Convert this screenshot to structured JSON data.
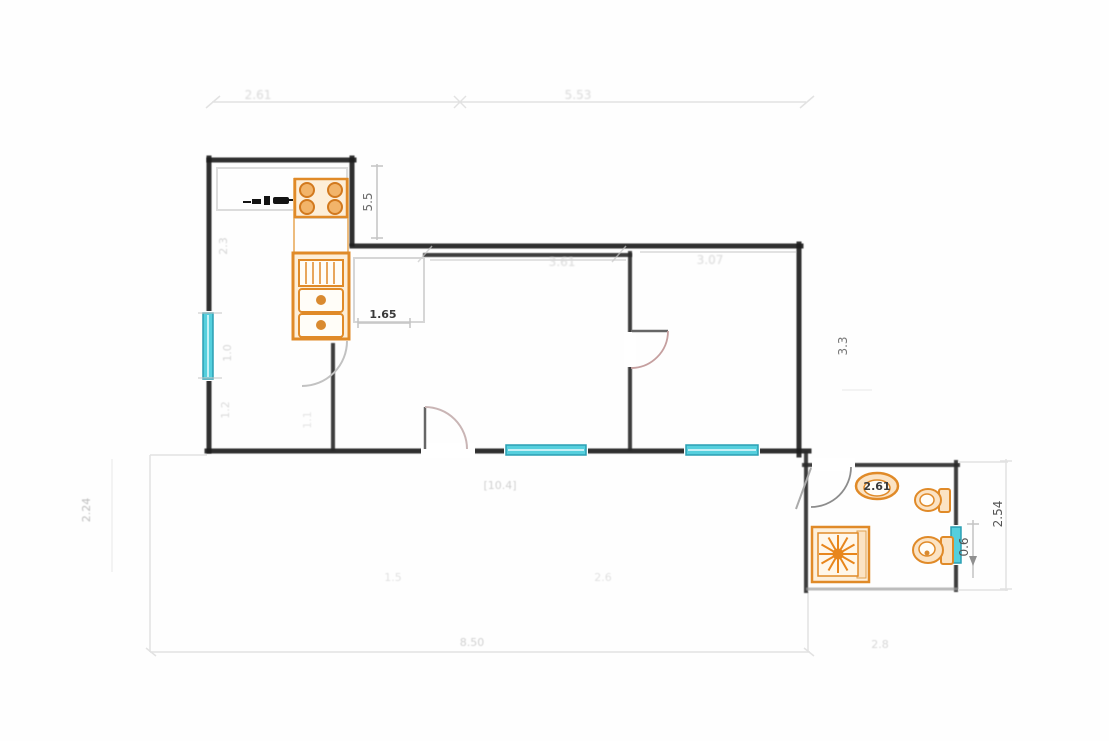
{
  "meta": {
    "drawing_type": "apartment floor plan scan",
    "rooms": [
      "kitchen",
      "hall",
      "living-room",
      "bedroom",
      "bathroom",
      "terrace"
    ],
    "fixtures": [
      "stove",
      "kitchen-sink",
      "drainboard",
      "counter",
      "washbasin",
      "bidet",
      "toilet",
      "shower",
      "entrance-door",
      "bedroom-door",
      "kitchen-door",
      "bathroom-door"
    ],
    "windows": [
      "kitchen-left-window",
      "living-room-window",
      "bedroom-window",
      "bathroom-window"
    ]
  },
  "colors": {
    "wall": "#1e1e1e",
    "fixture_orange": "#e08a28",
    "fixture_fill": "#fdeed8",
    "window_cyan": "#55cfdd",
    "window_border": "#2b9fb3",
    "dim_dark": "#3a3a3a",
    "dim_mid": "#555555",
    "dim_faint": "#bdbdbd"
  },
  "dimensions": {
    "top_left_width": "2.61",
    "top_right_width": "5.53",
    "stove_side": "5.5",
    "kitchen_wall": "2.3",
    "kitchen_window": "1.0",
    "kitchen_lower": "1.2",
    "kitchen_lower_b": "1.1",
    "hall_width": "1.65",
    "living_top": "3.61",
    "bedroom_top": "3.07",
    "right_mid": "3.3",
    "bath_width": "2.61",
    "bath_window": "0.6",
    "bath_right_height": "2.54",
    "terrace_left_height": "2.24",
    "terrace_area": "[10.4]",
    "terrace_seg_a": "1.5",
    "terrace_seg_b": "2.6",
    "bottom_total": "8.50",
    "bath_bottom": "2.8"
  }
}
